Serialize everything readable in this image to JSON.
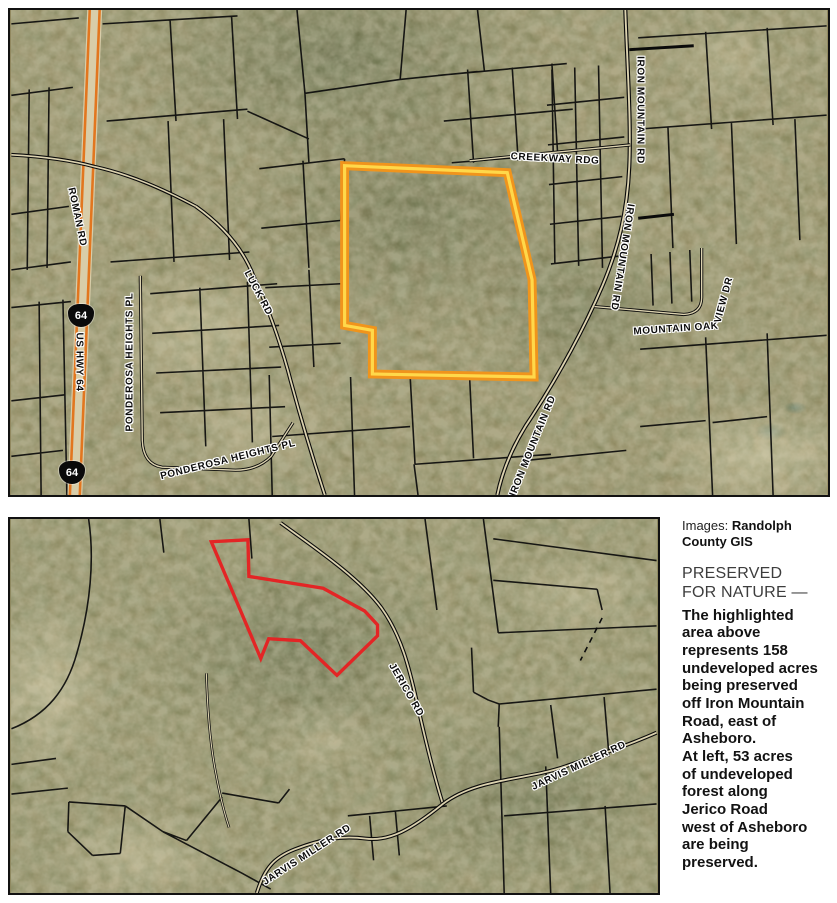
{
  "colors": {
    "highlight_yellow_core": "#FFD84A",
    "highlight_orange_edge": "#F0941C",
    "preserved_red": "#E32525",
    "highway_orange": "#E2761F",
    "parcel_black": "#0B0B0B"
  },
  "top_map": {
    "road_labels": {
      "roman_rd": "ROMAN RD",
      "us_hwy_64": "US HWY 64",
      "hwy_64_shield": "64",
      "ponderosa_heights_pl": "PONDEROSA HEIGHTS PL",
      "luck_rd": "LUCK RD",
      "creekway_rdg": "CREEKWAY RDG",
      "iron_mountain_rd": "IRON MOUNTAIN RD",
      "mountain_oak_view_dr": [
        "MOUNTAIN OAK",
        "VIEW DR"
      ]
    }
  },
  "bottom_map": {
    "road_labels": {
      "jerico_rd": "JERICO RD",
      "jarvis_miller_rd": "JARVIS MILLER RD"
    }
  },
  "caption": {
    "credit_prefix": "Images: ",
    "credit_source": "Randolph County GIS",
    "heading": "PRESERVED\nFOR NATURE —",
    "body": "The highlighted\narea above\nrepresents 158\nundeveloped acres\nbeing preserved\noff Iron Mountain\nRoad, east of\nAsheboro.\nAt left, 53 acres\nof undeveloped\nforest along\nJerico Road\nwest of Asheboro\nare being\npreserved."
  }
}
